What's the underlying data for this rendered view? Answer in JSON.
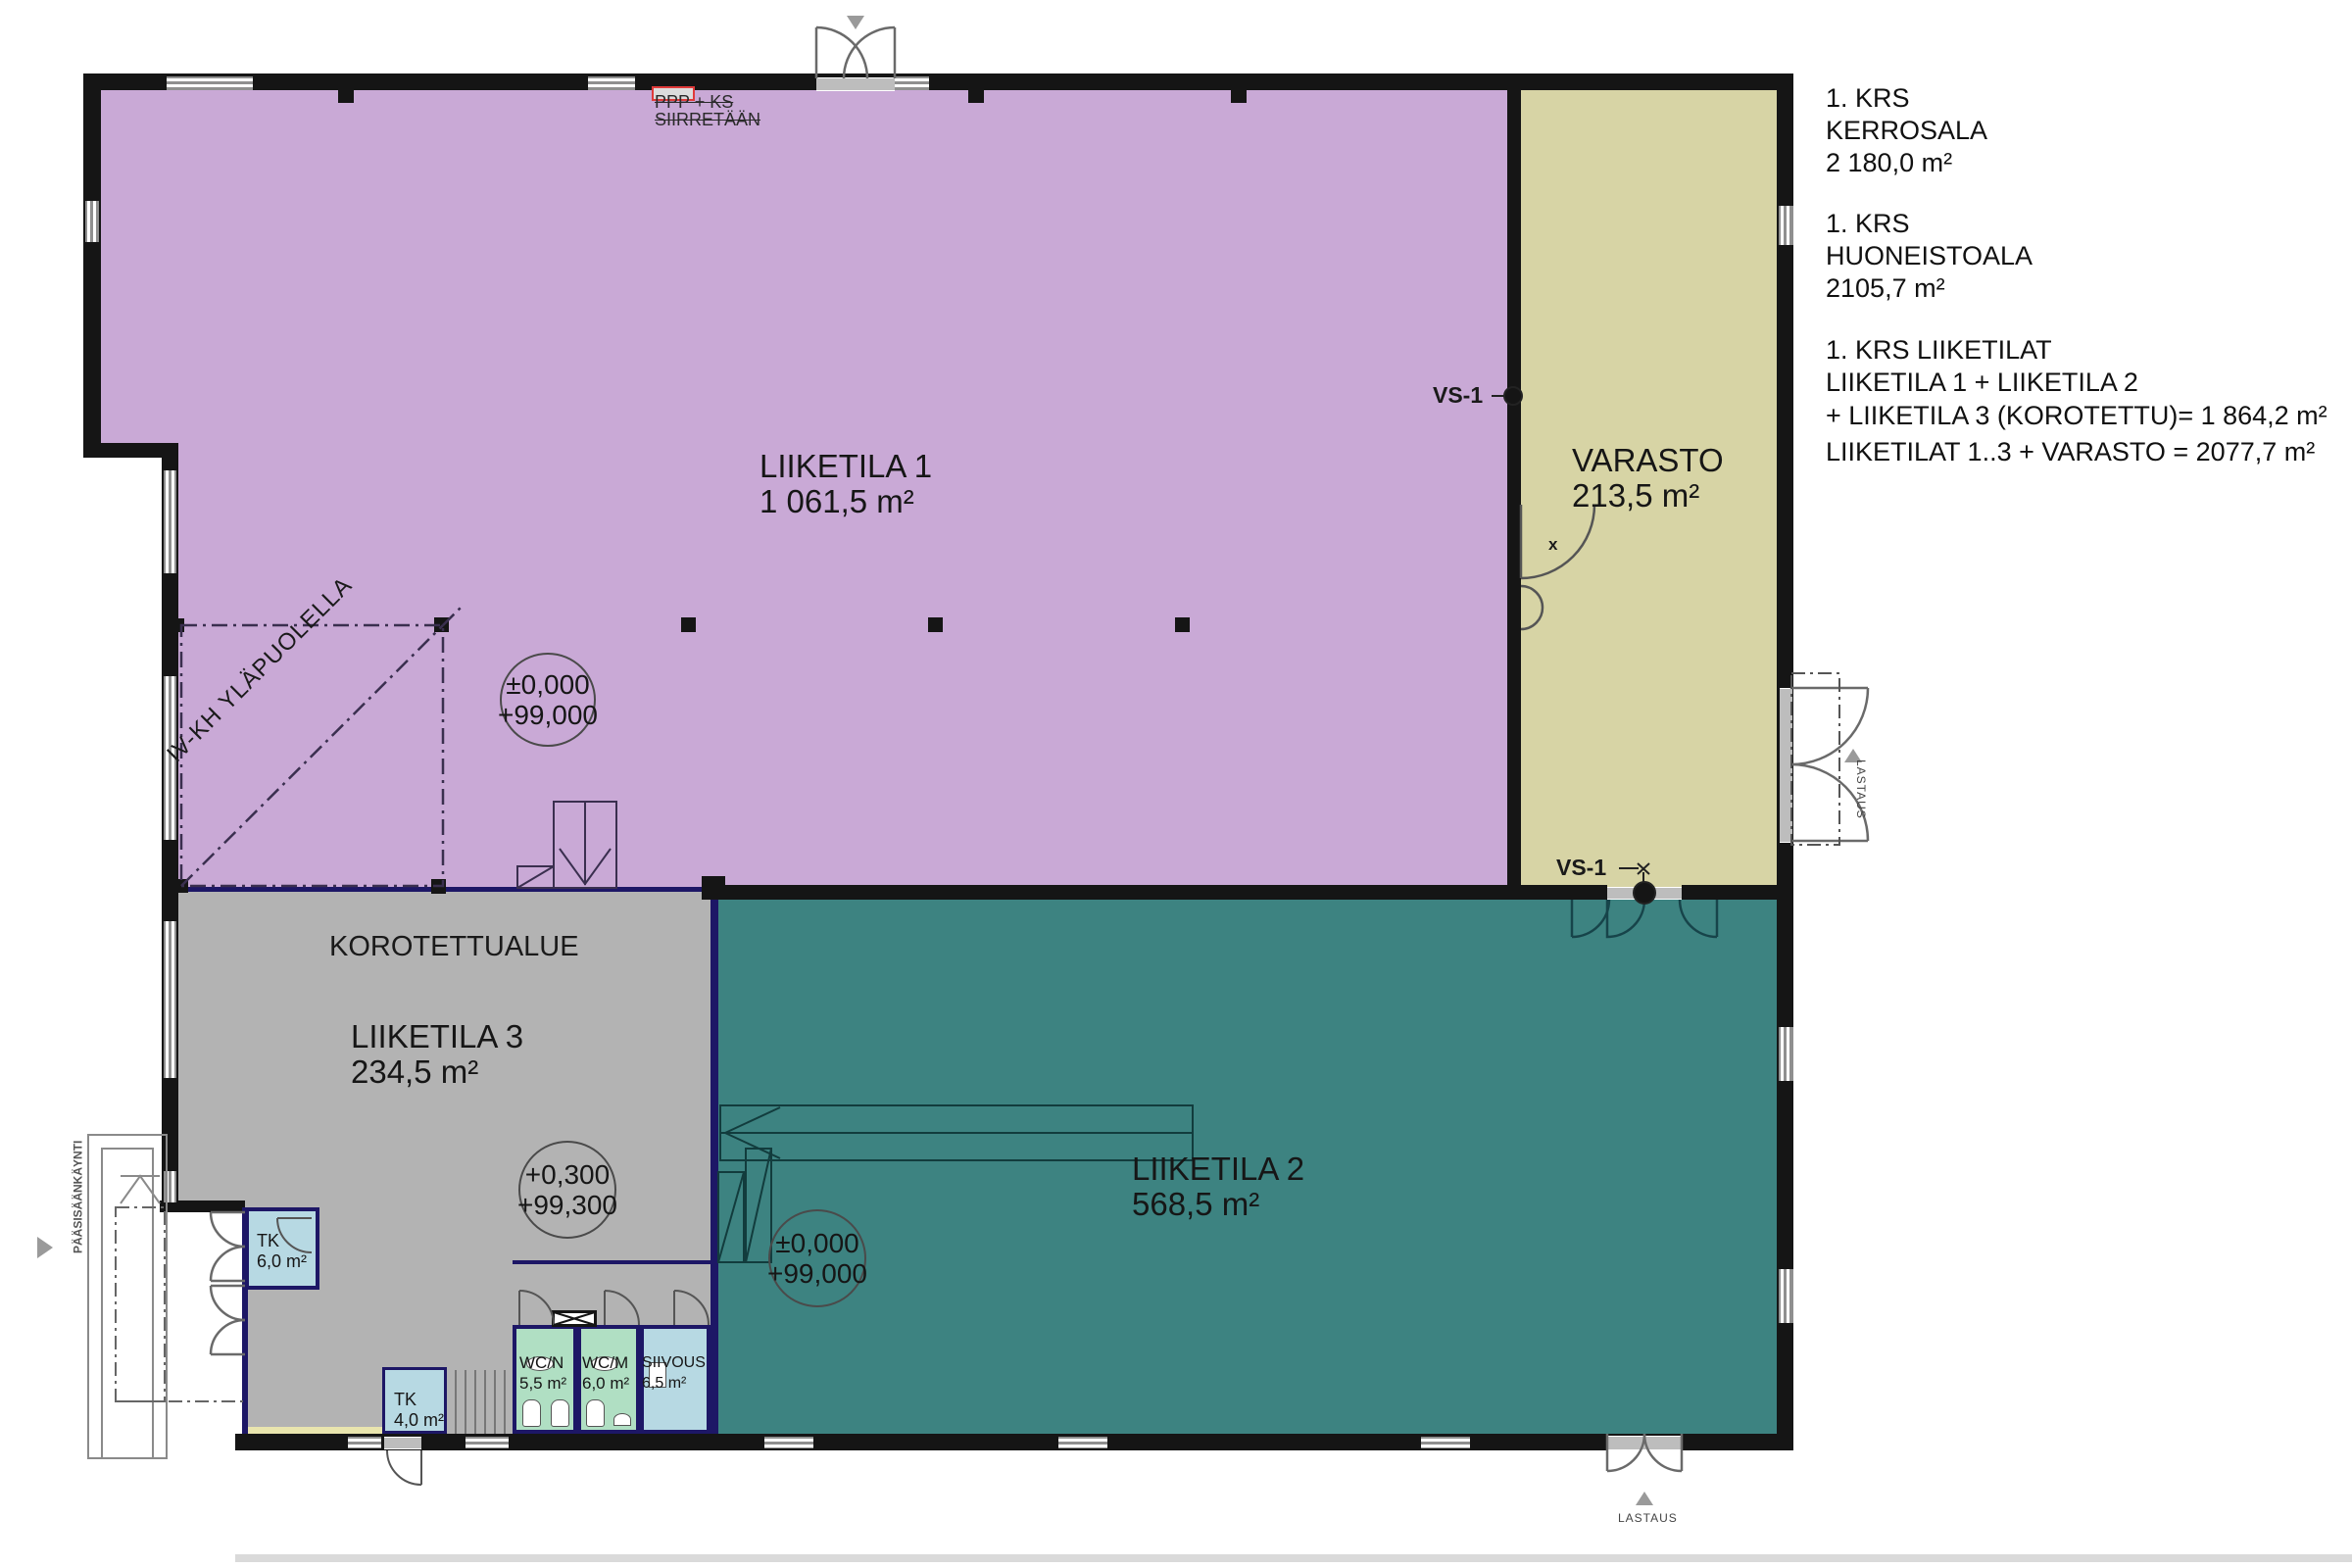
{
  "summary": {
    "block1": [
      "1. KRS",
      "KERROSALA",
      "2 180,0 m²"
    ],
    "block2": [
      "1. KRS",
      "HUONEISTOALA",
      "2105,7 m²"
    ],
    "block3": [
      "1. KRS LIIKETILAT",
      "LIIKETILA 1 + LIIKETILA 2",
      "+ LIIKETILA 3 (KOROTETTU)= 1 864,2 m²",
      "LIIKETILAT 1..3 + VARASTO = 2077,7 m²"
    ]
  },
  "rooms": {
    "liiketila1": {
      "name": "LIIKETILA 1",
      "area": "1 061,5 m²"
    },
    "varasto": {
      "name": "VARASTO",
      "area": "213,5 m²"
    },
    "liiketila3": {
      "name": "LIIKETILA 3",
      "area": "234,5 m²",
      "zone": "KOROTETTUALUE"
    },
    "liiketila2": {
      "name": "LIIKETILA 2",
      "area": "568,5 m²"
    },
    "tk_big": {
      "name": "TK",
      "area": "6,0 m²"
    },
    "tk_small": {
      "name": "TK",
      "area": "4,0 m²"
    },
    "wcn": {
      "name": "WC/N",
      "area": "5,5 m²"
    },
    "wcm": {
      "name": "WC/M",
      "area": "6,0 m²"
    },
    "siivous": {
      "name": "SIIVOUS",
      "area": "6,5 m²"
    }
  },
  "levels": {
    "l1": {
      "line1": "±0,000",
      "line2": "+99,000"
    },
    "l2": {
      "line1": "+0,300",
      "line2": "+99,300"
    },
    "l3": {
      "line1": "±0,000",
      "line2": "+99,000"
    }
  },
  "markers": {
    "vs1_top": "VS-1",
    "vs1_bottom": "VS-1",
    "iv_kh": "IV-KH YLÄPUOLELLA",
    "ppp_line1": "PPP + KS",
    "ppp_line2": "SIIRRETÄÄN",
    "entrance": "PÄÄSISÄÄNKÄYNTI",
    "lastaus_right": "LASTAUS",
    "lastaus_bottom": "LASTAUS",
    "door_x": "x"
  },
  "colors": {
    "liiketila1_fill": "#c9a9d6",
    "varasto_fill": "#d7d4a5",
    "liiketila2_fill": "#3d8381",
    "liiketila3_fill": "#b3b3b3",
    "tk_siivous_fill": "#b7d9e3",
    "wc_fill": "#b0dfc3",
    "raised_edge": "#1d1766",
    "wall": "#151515",
    "revision_red": "#e03a3a"
  }
}
